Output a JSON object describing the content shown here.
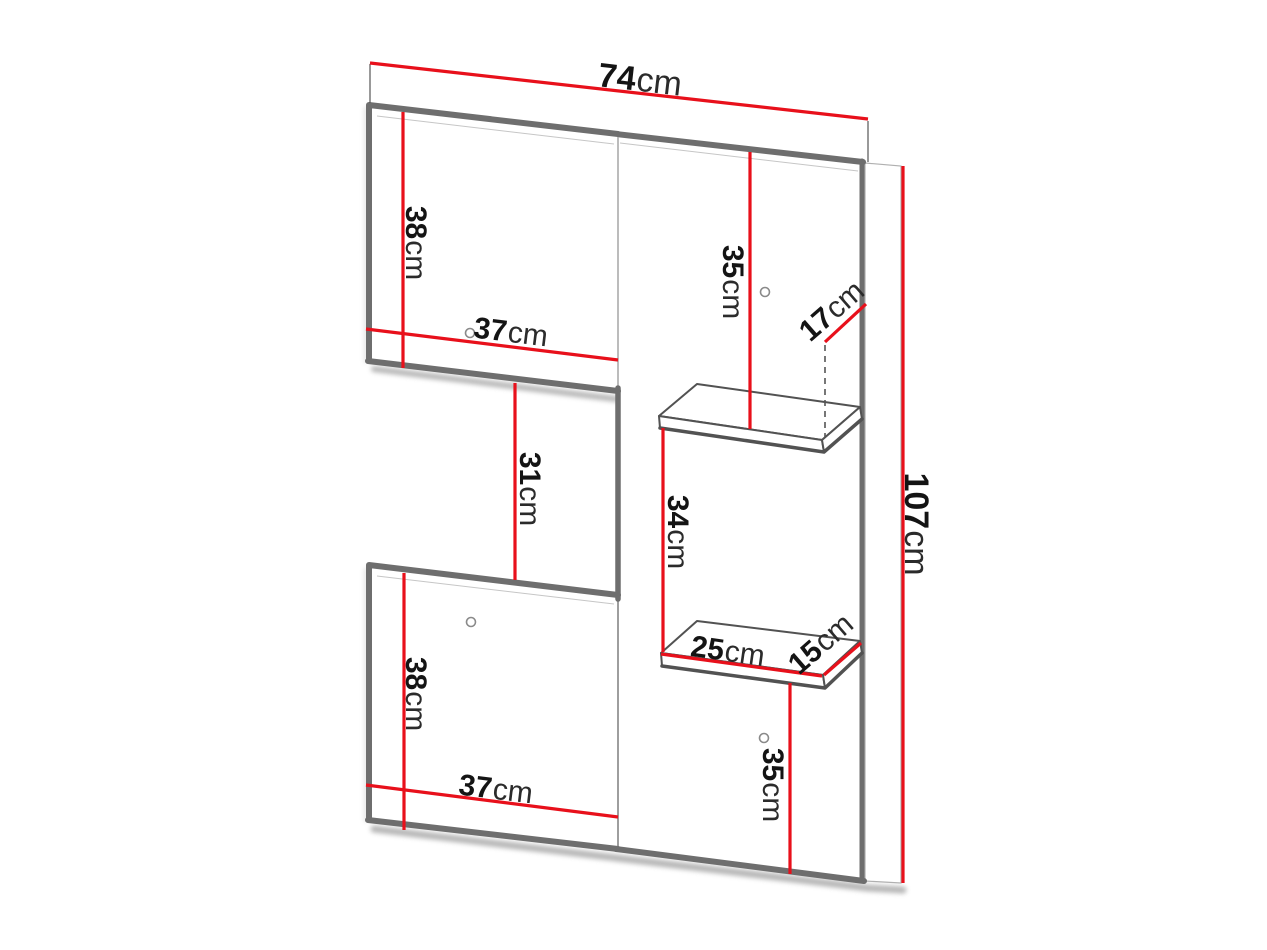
{
  "diagram": {
    "title": "wall-panel-furniture-dimension-diagram",
    "colors": {
      "background": "#ffffff",
      "dimension_red": "#e8101b",
      "edge_gray": "#6e6e6e",
      "thin_gray": "#a0a0a0",
      "shadow_gray": "#9e9e9e",
      "text_black": "#141414"
    },
    "dims": {
      "overall_width": {
        "value": "74",
        "unit": "cm"
      },
      "overall_height": {
        "value": "107",
        "unit": "cm"
      },
      "upper_cabinet_height": {
        "value": "38",
        "unit": "cm"
      },
      "upper_cabinet_width": {
        "value": "37",
        "unit": "cm"
      },
      "middle_gap_height": {
        "value": "31",
        "unit": "cm"
      },
      "upper_clearance": {
        "value": "35",
        "unit": "cm"
      },
      "upper_shelf_depth": {
        "value": "17",
        "unit": "cm"
      },
      "between_shelves": {
        "value": "34",
        "unit": "cm"
      },
      "lower_shelf_width": {
        "value": "25",
        "unit": "cm"
      },
      "lower_shelf_depth": {
        "value": "15",
        "unit": "cm"
      },
      "lower_clearance": {
        "value": "35",
        "unit": "cm"
      },
      "lower_cabinet_height": {
        "value": "38",
        "unit": "cm"
      },
      "lower_cabinet_width": {
        "value": "37",
        "unit": "cm"
      }
    }
  }
}
